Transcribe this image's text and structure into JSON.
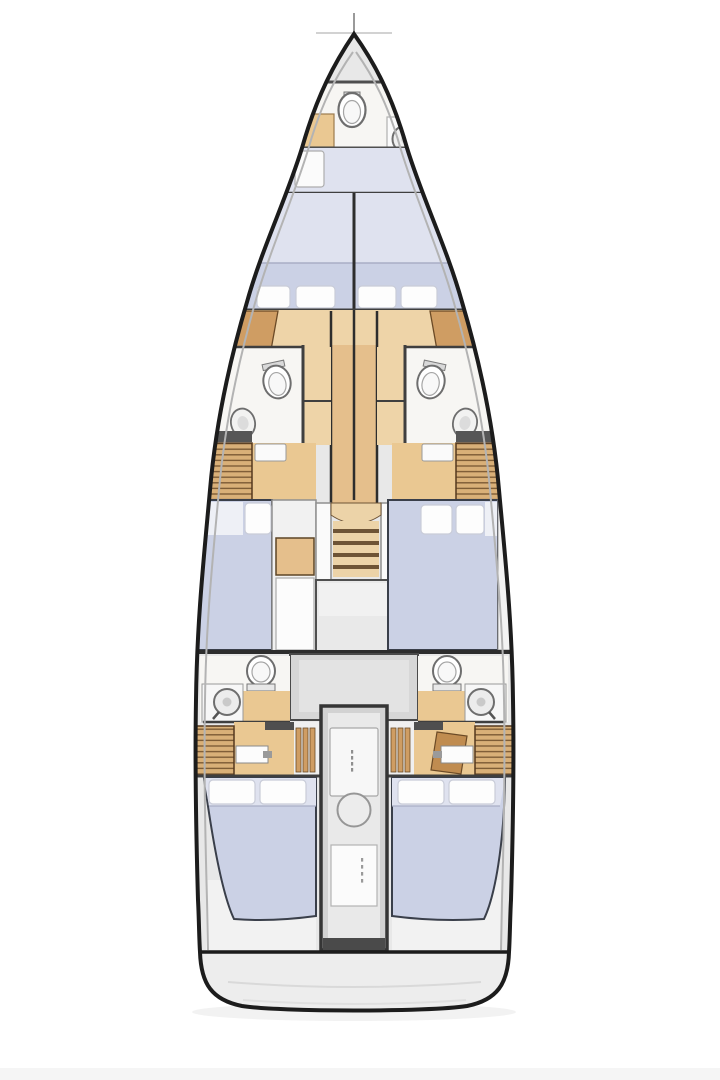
{
  "palette": {
    "page_bg": "#ffffff",
    "hull_line": "#1c1c1c",
    "inner_hull": "#b3b3b3",
    "deck": "#e8e8e8",
    "room": "#f7f6f3",
    "wall": "#3f3f3f",
    "bulkhead": "#4f4f4f",
    "bed": "#cbd1e5",
    "bed_light": "#dfe2ef",
    "sheet": "#eef0f6",
    "pillow": "#fdfdfd",
    "wood": "#eac892",
    "wood_light": "#eed4a8",
    "wood_mid": "#e5bf8c",
    "wood_dark": "#cf9d63",
    "wood_deep": "#c08c50",
    "slat": "#d9b078",
    "slat_line": "#7d5c36",
    "slat_border": "#54391e",
    "tread": "#ecd3a8",
    "riser": "#6e5436",
    "gray_panel": "#d7d7d7",
    "landing": "#e9e9e9",
    "column": "#e9e9e9",
    "fixture_stroke": "#6e6e6e",
    "transom": "#ededed"
  }
}
